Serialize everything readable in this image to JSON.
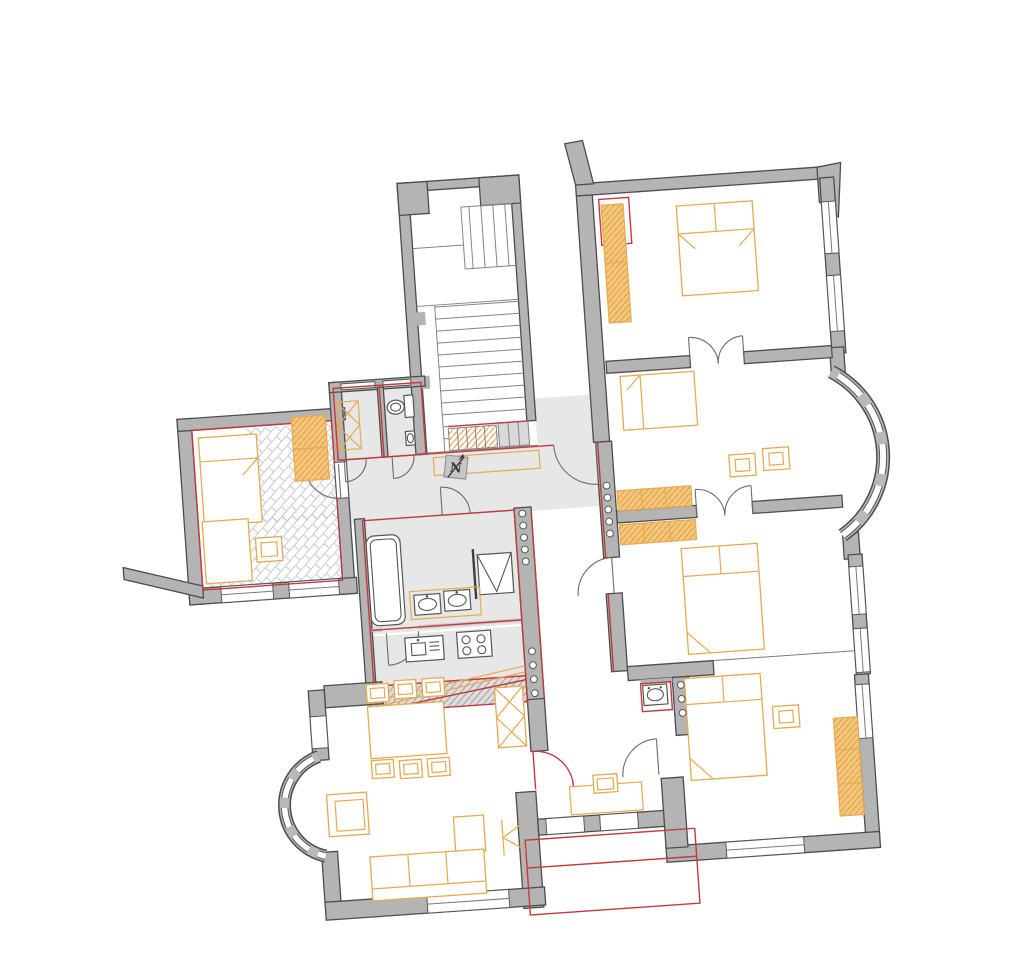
{
  "north_indicator": {
    "label": "N"
  },
  "colors": {
    "background": "#ffffff",
    "wall_fill": "#b4b4b4",
    "wall_outline": "#4d4d4d",
    "floor": "#e7e7e7",
    "furniture": "#e9a94f",
    "wardrobe_fill": "#f5c77c",
    "wardrobe_hatch": "#dd9e44",
    "renovation_red": "#c23a3f",
    "demolition_hatch": "#9c9c9c",
    "parquet_hatch": "#c5cad3",
    "fixture": "#565656"
  }
}
